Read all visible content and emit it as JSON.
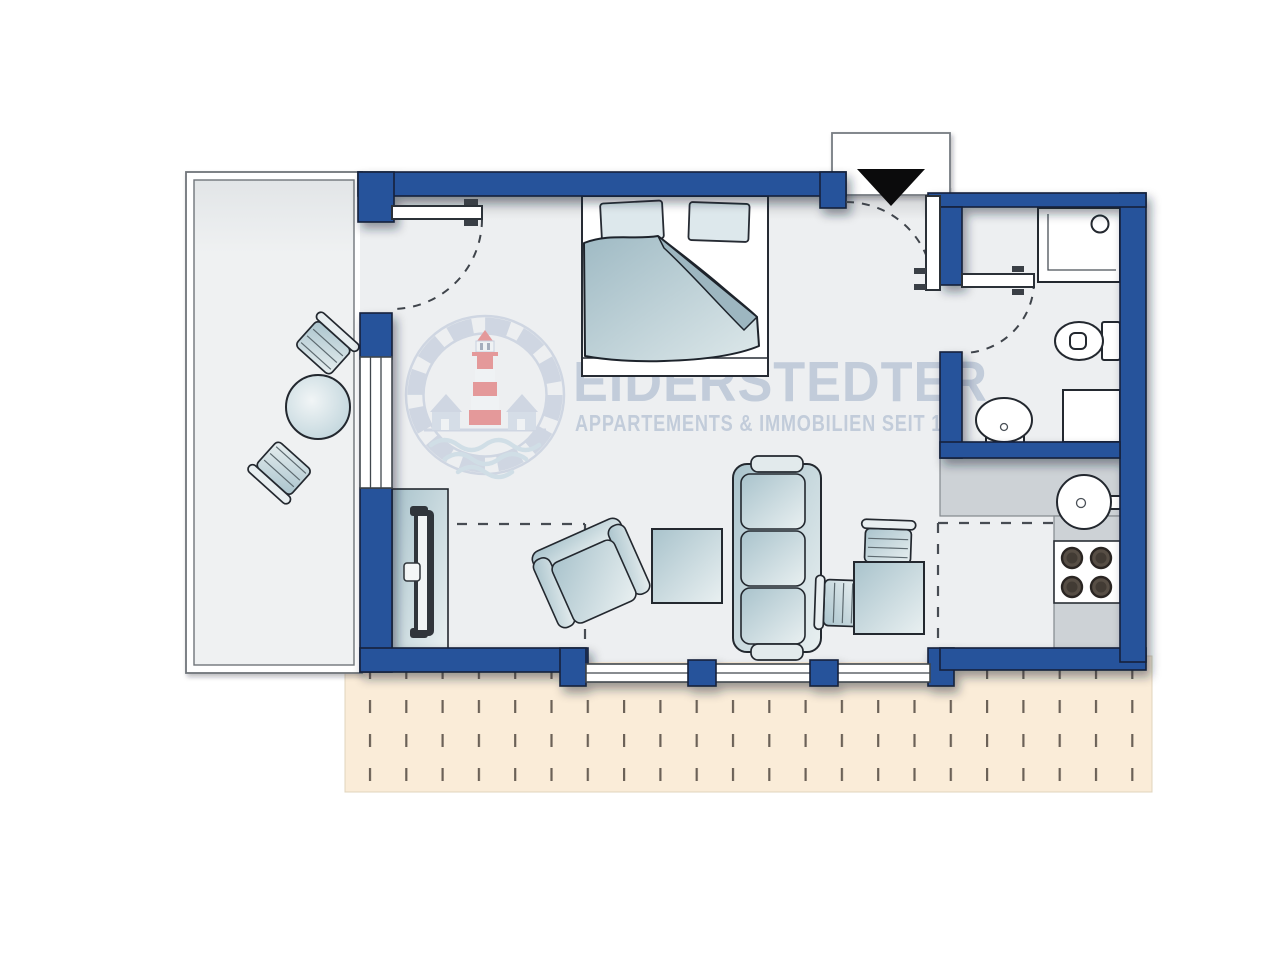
{
  "watermark": {
    "brand": "EIDERSTEDTER",
    "tagline": "APPARTEMENTS & IMMOBILIEN SEIT 19"
  },
  "colors": {
    "wall": "#27529B",
    "floor": "#EDEFF1",
    "terrace": "#FAECD8",
    "tdash": "#6B6157",
    "counter": "#CDD2D6",
    "outline": "#23282F",
    "logoblue": "#B7C3D6",
    "logored": "#DE5454",
    "wave": "#BAD1DE",
    "wmtext": "#C2CCDA",
    "arrow": "#0B0B0C"
  },
  "plan": {
    "rooms": [
      "balcony",
      "living-sleeping-room",
      "hall",
      "bathroom",
      "kitchenette",
      "terrace"
    ],
    "furniture": [
      "double-bed",
      "sofa",
      "armchair",
      "coffee-table",
      "dining-table",
      "dining-chair",
      "tv-sideboard",
      "balcony-table",
      "balcony-chair",
      "shower",
      "toilet",
      "bathroom-sink",
      "bathroom-washer",
      "kitchen-sink",
      "stove"
    ],
    "doors": [
      "entrance-door",
      "balcony-door",
      "bathroom-door"
    ],
    "entrance_marker": "black-triangle-arrow"
  }
}
